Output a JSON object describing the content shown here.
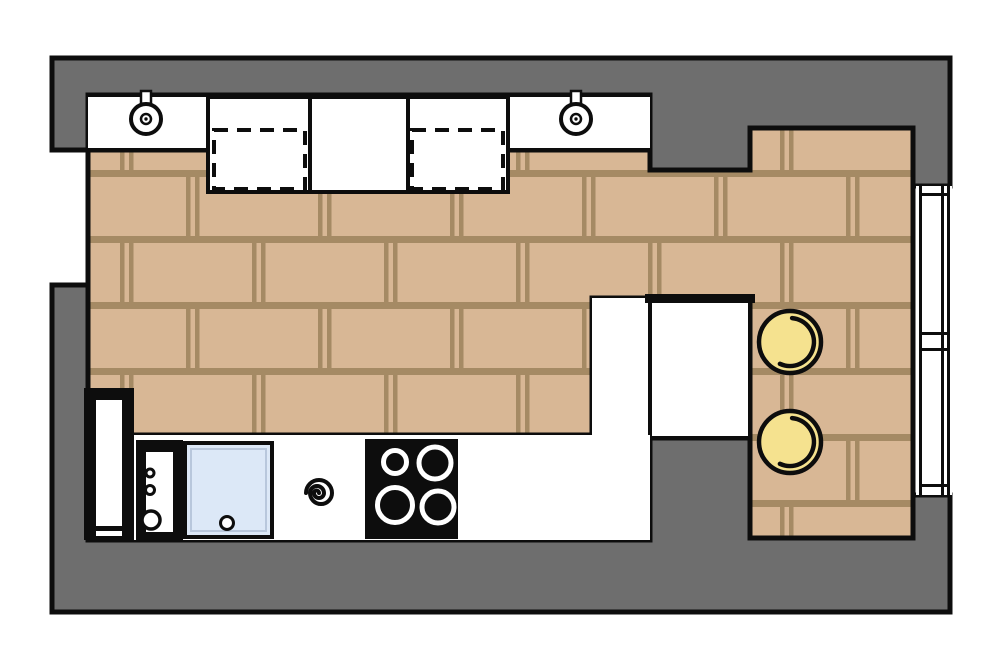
{
  "title": "kitchen-floor-plan",
  "colors": {
    "background": "#ffffff",
    "wall": "#6e6e6e",
    "outline": "#0d0d0d",
    "brick": "#d8b795",
    "mortar": "#a58a64",
    "counter": "#ffffff",
    "deep_cabinet": "#ffffff",
    "table": "#ffffff",
    "appliance_black": "#0d0d0d",
    "appliance_inner": "#ffffff",
    "sink": "#dce8f7",
    "sink_keyline": "#b8c7dc",
    "cooktop": "#0d0d0d",
    "burner_ring": "#ffffff",
    "stool": "#f5e28f",
    "fixture_fill": "#ffffff",
    "window_fill": "#ffffff"
  },
  "inventory": {
    "wall_fixtures": 2,
    "dashed_appliance_outlines": 2,
    "tall_units": 2,
    "unit_knobs": 3,
    "sink_drains": 1,
    "cooktop_burners": 4,
    "stools": 2,
    "window_tick_marks": 4,
    "door_openings": 1
  }
}
